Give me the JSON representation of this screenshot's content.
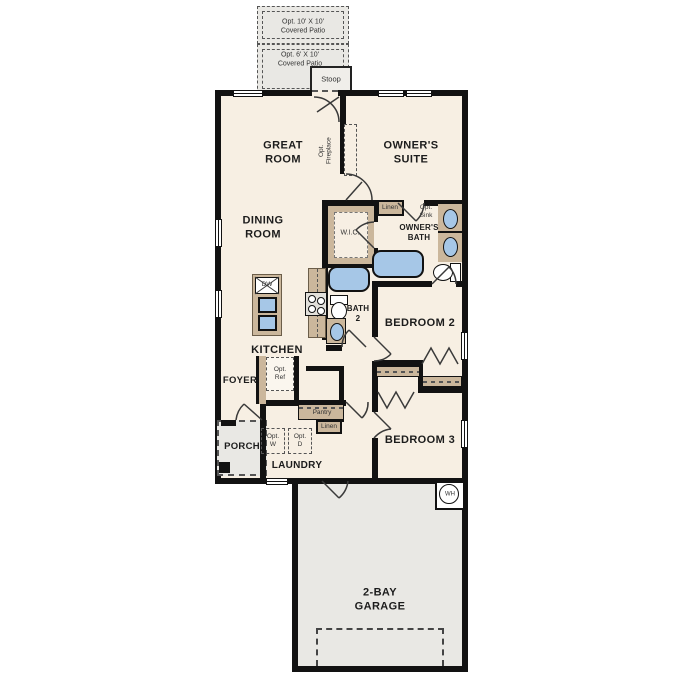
{
  "colors": {
    "wall": "#121212",
    "interior_floor": "#f7efe3",
    "concrete": "#e9e8e4",
    "cabinetry_tan": "#cbb79c",
    "fixture_blue": "#a6c7e7"
  },
  "exterior": {
    "patio_10_label": "Opt. 10' X 10'\nCovered Patio",
    "patio_6_label": "Opt. 6' X 10'\nCovered Patio",
    "stoop_label": "Stoop",
    "porch_label": "PORCH"
  },
  "rooms": {
    "great_room": "GREAT\nROOM",
    "owners_suite": "OWNER'S\nSUITE",
    "dining_room": "DINING\nROOM",
    "kitchen": "KITCHEN",
    "foyer": "FOYER",
    "laundry": "LAUNDRY",
    "bedroom_2": "BEDROOM 2",
    "bedroom_3": "BEDROOM 3",
    "owners_bath": "OWNER'S\nBATH",
    "bath_2": "BATH\n2",
    "wic": "W.I.C.",
    "garage": "2-BAY\nGARAGE"
  },
  "features": {
    "opt_fireplace": "Opt.\nFireplace",
    "linen_upper": "Linen",
    "linen_lower": "Linen",
    "pantry": "Pantry",
    "opt_ref": "Opt.\nRef",
    "opt_washer": "Opt.\nW",
    "opt_dryer": "Opt.\nD",
    "opt_sink": "Opt.\nSink",
    "dishwasher": "DW",
    "water_heater": "WH"
  }
}
